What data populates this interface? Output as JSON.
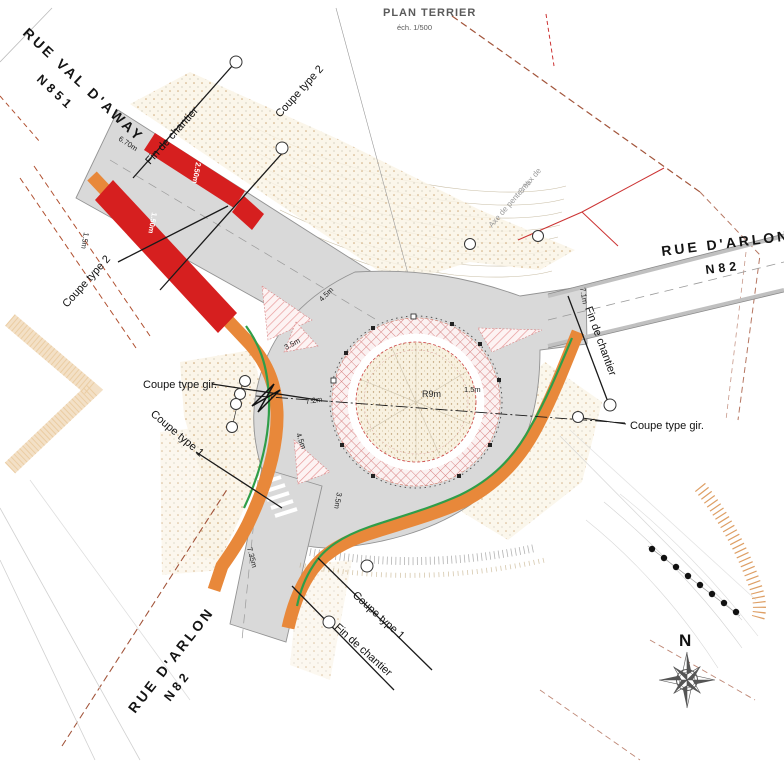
{
  "title": {
    "main": "PLAN TERRIER",
    "scale": "éch. 1/500"
  },
  "streets": {
    "northwest": {
      "name": "RUE VAL D'AWAY",
      "ref": "N851"
    },
    "east": {
      "name": "RUE D'ARLON",
      "ref": "N82"
    },
    "south": {
      "name": "RUE D'ARLON",
      "ref": "N82"
    }
  },
  "annotations": {
    "fin_de_chantier": "Fin de chantier",
    "coupe_type_1": "Coupe type 1",
    "coupe_type_2": "Coupe type 2",
    "coupe_type_gir": "Coupe type gir.",
    "axe_line1": "Axe de pente max de",
    "axe_line2": "3 %"
  },
  "dimensions": {
    "nw_road_width": "6.70m",
    "nw_red_outer": "2.50m",
    "nw_red_inner": "1.50m",
    "nw_verge": "1.5m",
    "entry_north": "4.5m",
    "island_north": "3.5m",
    "ring_lane": "7.2m",
    "entry_south": "4.5m",
    "south_island": "3.5m",
    "roundabout_radius": "R9m",
    "apron": "1.5m",
    "east_road_width": "7.1m",
    "south_road_width": "7.35m"
  },
  "compass": {
    "north": "N"
  },
  "colors": {
    "road_gray": "#d9d9d9",
    "new_curb_orange": "#e8883a",
    "demolition_red": "#d61f1f",
    "green_edge": "#2f9e49",
    "island_pink": "#eba7a7",
    "cadastral_brown": "#a2543a"
  }
}
